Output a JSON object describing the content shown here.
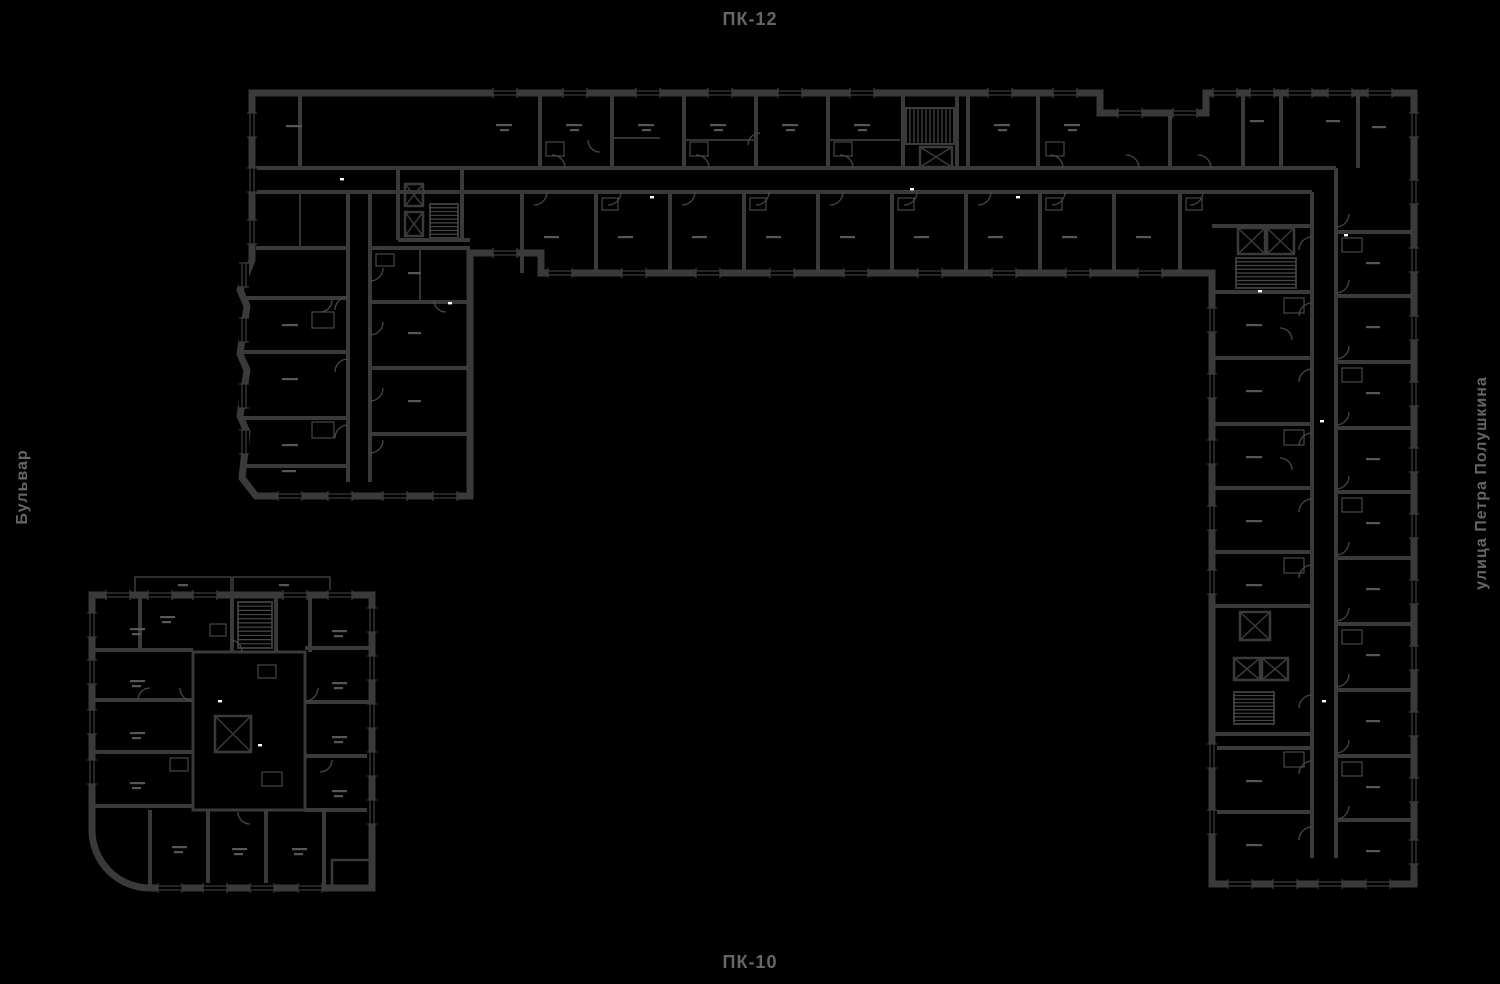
{
  "labels": {
    "top": "ПК-12",
    "bottom": "ПК-10",
    "left": "Бульвар",
    "right": "улица Петра Полушкина"
  },
  "colors": {
    "background": "#000000",
    "wall": "#3a3a3a",
    "partition": "#343434",
    "detail": "#474747",
    "fixture": "#575757",
    "label_text": "#666666",
    "highlight": "#ffffff"
  },
  "drawing": {
    "type": "architectural-floor-plan",
    "features": [
      "elevator-core",
      "stair-core",
      "apartment-partitions",
      "window-openings",
      "door-swing-arcs"
    ]
  }
}
